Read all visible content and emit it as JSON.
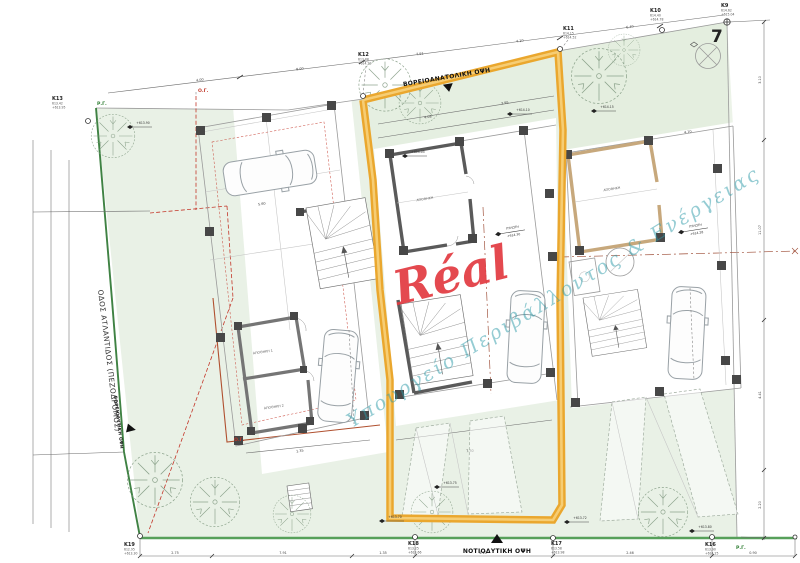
{
  "watermark": {
    "brand": "Réal",
    "diagonal": "Υπουργείο Περιβάλλοντος & Ενέργειας"
  },
  "street": {
    "name": "ΟΔΟΣ ΑΤΛΑΝΤΙΔΟΣ (ΠΕΖΟΔΡΟΜΟΣ)"
  },
  "plot": {
    "number": "7"
  },
  "views": {
    "ne": "ΒΟΡΕΙΟΑΝΑΤΟΛΙΚΗ ΟΨΗ",
    "sw": "ΝΟΤΙΟΔΥΤΙΚΗ ΟΨΗ",
    "nw": "ΒΟΡΕΙΟΔΥΤΙΚΗ ΟΨΗ"
  },
  "lines": {
    "og": "Ο.Γ.",
    "rg": "Ρ.Γ."
  },
  "survey": [
    {
      "id": "K13",
      "l1": "613.42",
      "l2": "+613.95"
    },
    {
      "id": "K12",
      "l1": "613.88",
      "l2": "+614.20"
    },
    {
      "id": "K11",
      "l1": "614.15",
      "l2": "+614.52"
    },
    {
      "id": "K10",
      "l1": "614.40",
      "l2": "+614.78"
    },
    {
      "id": "K9",
      "l1": "614.62",
      "l2": "+615.04"
    },
    {
      "id": "K19",
      "l1": "612.95",
      "l2": "+613.30"
    },
    {
      "id": "K18",
      "l1": "613.25",
      "l2": "+613.66"
    },
    {
      "id": "K17",
      "l1": "613.58",
      "l2": "+613.98"
    },
    {
      "id": "K16",
      "l1": "613.90",
      "l2": "+614.25"
    }
  ],
  "rooms": {
    "store1": "ΑΠΟΘΗΚΗ 1",
    "store2": "ΑΠΟΘΗΚΗ 2",
    "storeM": "ΑΠΟΘΗΚΗ",
    "storeR": "ΑΠΟΘΗΚΗ",
    "pilotis": "ΠΥΛΩΤΗ",
    "pilotis_level": "+614.30",
    "pilotis_r": "ΠΥΛΩΤΗ",
    "pilotis_level_r": "+614.28"
  },
  "spots": [
    "+613.90",
    "+614.05",
    "+614.10",
    "+614.15",
    "+613.75",
    "+613.70",
    "+613.72",
    "+613.80"
  ],
  "dims": {
    "top": [
      "4.00",
      "8.00",
      "7.91",
      "4.10",
      "6.40"
    ],
    "bottom": [
      "2.75",
      "7.91",
      "1.35",
      "4.10",
      "2.46",
      "0.90"
    ],
    "right": [
      "3.10",
      "11.07",
      "4.41",
      "2.20"
    ],
    "inner": [
      "4.08",
      "3.95",
      "5.60",
      "4.10",
      "7.30",
      "1.35"
    ]
  },
  "colors": {
    "highlight_boundary": "#EAA72E",
    "regulation_line_green": "#3F8243",
    "building_line_red": "#C0392B",
    "brand_red": "#E23A41",
    "watermark_teal": "#2D9AA8",
    "site_green": "#E9F1E6"
  }
}
